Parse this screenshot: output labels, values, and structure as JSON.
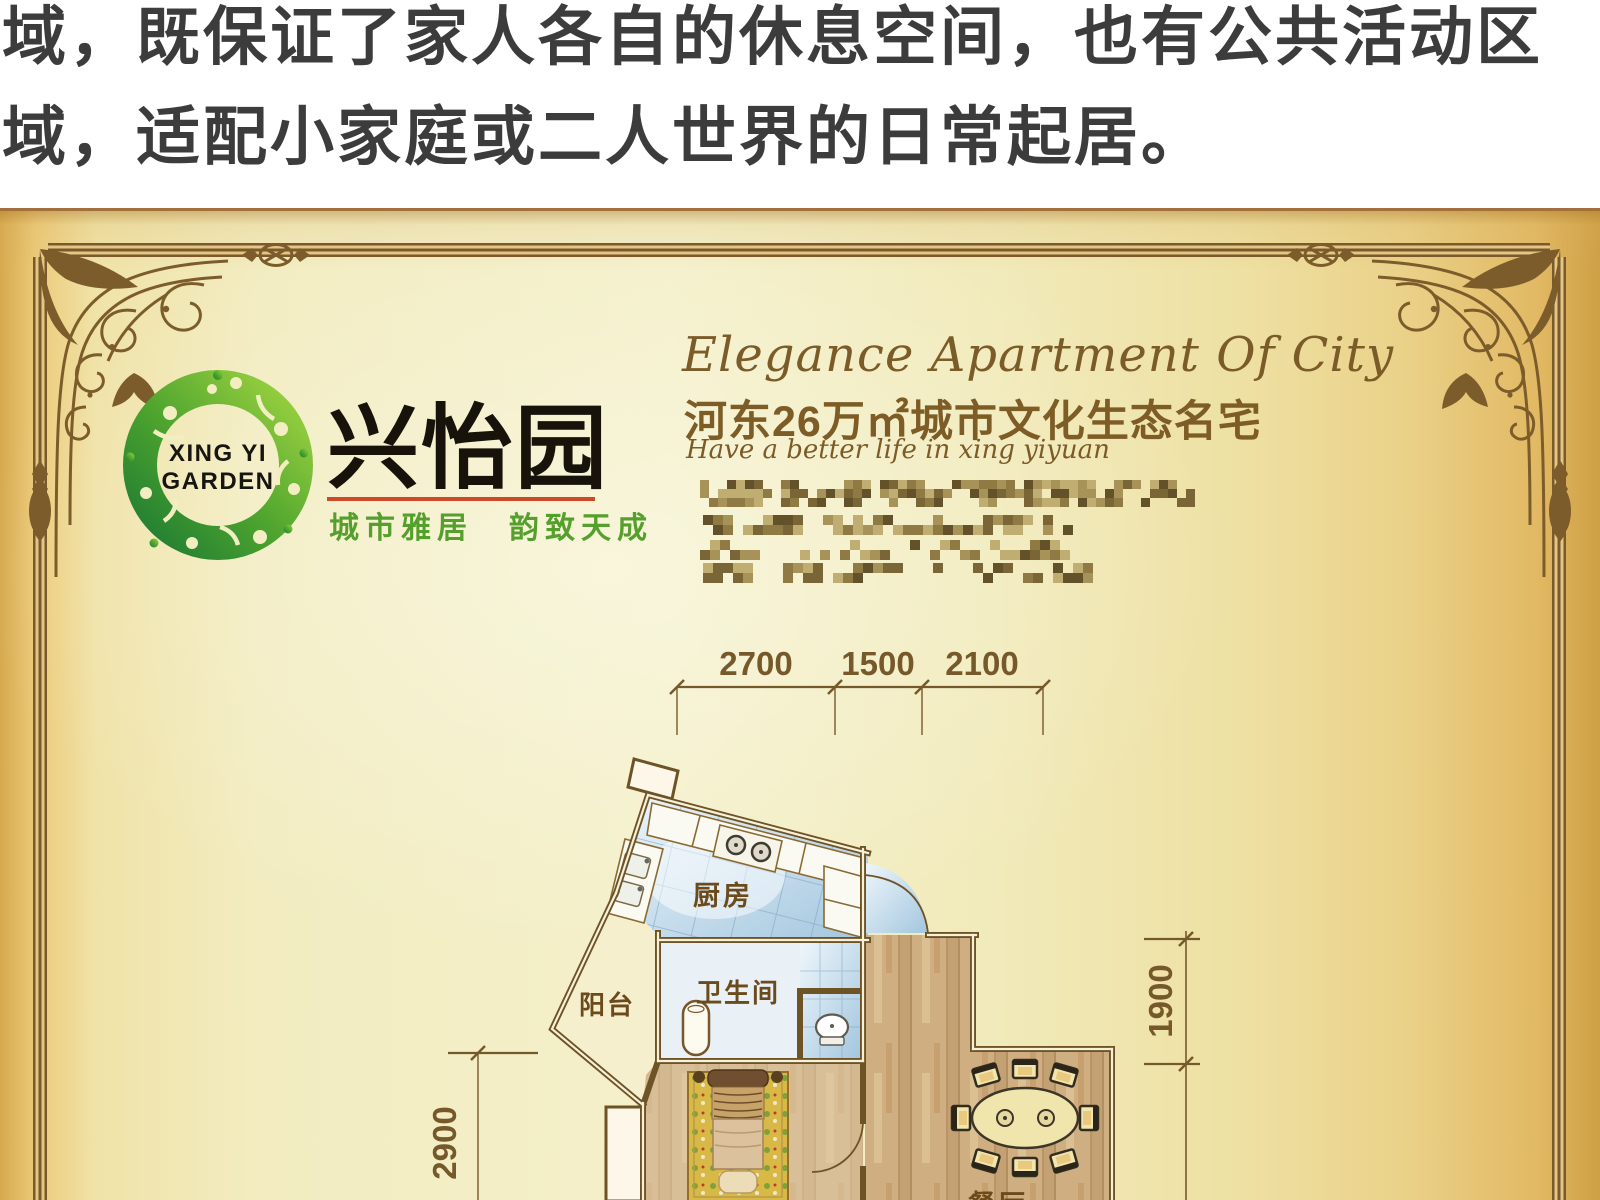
{
  "intro": {
    "line1": "域，既保证了家人各自的休息空间，也有公共活动区",
    "line2": "域，适配小家庭或二人世界的日常起居。"
  },
  "poster": {
    "logo": {
      "mark_line1": "XING YI",
      "mark_line2": "GARDEN",
      "name": "兴怡园",
      "tagline": "城市雅居　韵致天成"
    },
    "headline_en": "Elegance Apartment Of City",
    "headline_cn": "河东26万㎡城市文化生态名宅",
    "subheadline_en": "Have a better life in xing yiyuan",
    "redacted_contact": {
      "style": "pixelated-mosaic",
      "palette": [
        "#63512a",
        "#7a6536",
        "#8f7a44",
        "#a79258",
        "#c0ad72"
      ],
      "lines": [
        {
          "x": 700,
          "y": 269,
          "w": 495,
          "h": 27,
          "block": 9,
          "density": 0.58
        },
        {
          "x": 703,
          "y": 304,
          "w": 370,
          "h": 20,
          "block": 10,
          "density": 0.5
        },
        {
          "x": 700,
          "y": 329,
          "w": 370,
          "h": 20,
          "block": 10,
          "density": 0.5
        },
        {
          "x": 703,
          "y": 352,
          "w": 394,
          "h": 20,
          "block": 10,
          "density": 0.52
        }
      ]
    },
    "floorplan": {
      "dimensions": {
        "top": [
          "2700",
          "1500",
          "2100"
        ],
        "left": "2900",
        "right": "1900"
      },
      "rooms": {
        "kitchen": "厨房",
        "balcony": "阳台",
        "bathroom": "卫生间",
        "dining": "餐厅"
      }
    },
    "colors": {
      "frame": "#7d5c2b",
      "dimension_text": "#76592b",
      "headline_brown": "#7b5b28",
      "tagline_green": "#55a02c",
      "underline_red": "#cc4a28",
      "logo_green_dark": "#1f7c33",
      "logo_green_light": "#9ed341",
      "wall": "#6d5326",
      "tile_blue": "#b6d4e7",
      "wood": "#cfae82"
    }
  }
}
